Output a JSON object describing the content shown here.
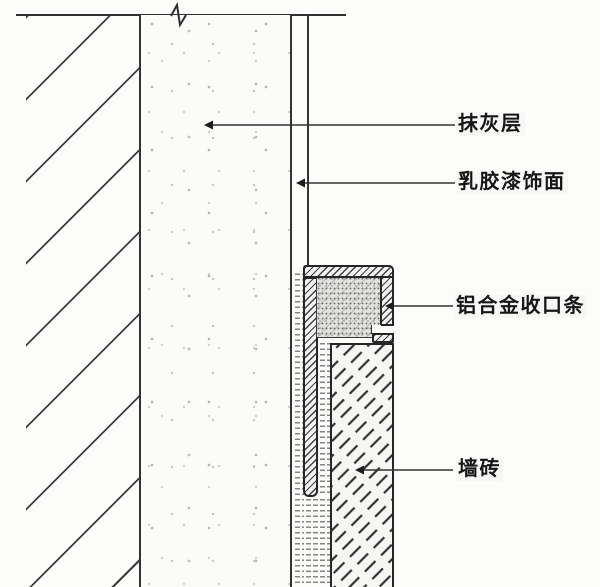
{
  "drawing": {
    "labels": {
      "plaster": "抹灰层",
      "paint": "乳胶漆饰面",
      "trim": "铝合金收口条",
      "tile": "墙砖"
    },
    "colors": {
      "line": "#2f2f2f",
      "background": "#fcfcfb",
      "hatch": "#3e3e3e",
      "infill_gray": "#e2e2df"
    }
  }
}
